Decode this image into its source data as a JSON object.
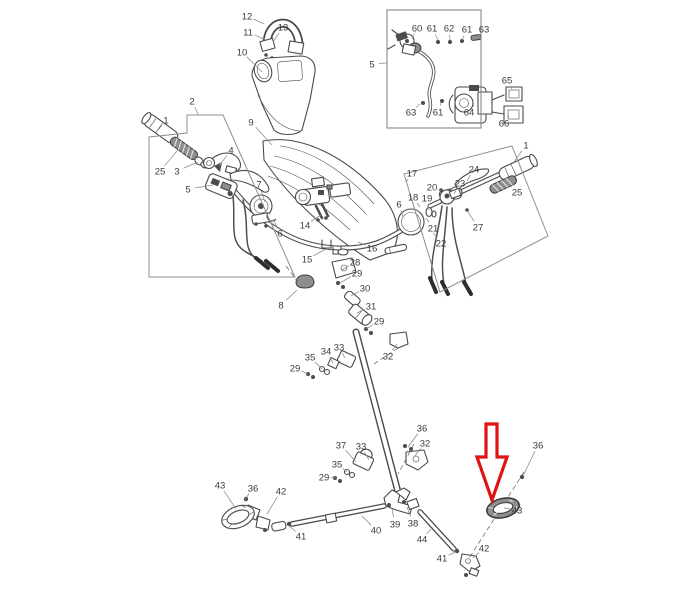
{
  "figure": {
    "kind": "exploded-parts-diagram",
    "subject": "handlebar and steering column assembly",
    "width": 691,
    "height": 600,
    "background": "#ffffff",
    "line_color": "#4a4a4a",
    "label_color": "#3b3b3b",
    "leader_color": "#8a8a8a",
    "label_font_px": 9.5
  },
  "highlight_arrow": {
    "color": "#e11212",
    "fill": "#ffffff",
    "points_to_part": "43",
    "polygon": [
      [
        486,
        424
      ],
      [
        497,
        424
      ],
      [
        497,
        457
      ],
      [
        507,
        457
      ],
      [
        492,
        500
      ],
      [
        477,
        457
      ],
      [
        486,
        457
      ]
    ]
  },
  "callout_regions": [
    {
      "name": "left-controls-region",
      "label": "2",
      "color": "#8f8f8f",
      "points": [
        [
          187,
          115
        ],
        [
          223,
          115
        ],
        [
          295,
          277
        ],
        [
          149,
          277
        ],
        [
          149,
          137
        ],
        [
          187,
          133
        ]
      ],
      "closed": true
    },
    {
      "name": "right-controls-region",
      "label": "17",
      "color": "#8f8f8f",
      "points": [
        [
          404,
          174
        ],
        [
          512,
          146
        ],
        [
          548,
          236
        ],
        [
          440,
          292
        ]
      ],
      "closed": true
    },
    {
      "name": "inset-detail-box",
      "label": "5",
      "color": "#7d7d7d",
      "points": [
        [
          387,
          10
        ],
        [
          481,
          10
        ],
        [
          481,
          128
        ],
        [
          387,
          128
        ]
      ],
      "closed": true
    }
  ],
  "part_labels": [
    {
      "n": "12",
      "x": 247,
      "y": 16,
      "lx": 264,
      "ly": 24
    },
    {
      "n": "11",
      "x": 248,
      "y": 32,
      "lx": 266,
      "ly": 40
    },
    {
      "n": "13",
      "x": 283,
      "y": 27,
      "lx": 273,
      "ly": 42
    },
    {
      "n": "10",
      "x": 242,
      "y": 52,
      "lx": 262,
      "ly": 72
    },
    {
      "n": "2",
      "x": 192,
      "y": 101,
      "lx": 198,
      "ly": 114
    },
    {
      "n": "9",
      "x": 251,
      "y": 122,
      "lx": 272,
      "ly": 145
    },
    {
      "n": "1",
      "x": 166,
      "y": 120,
      "lx": 158,
      "ly": 130
    },
    {
      "n": "25",
      "x": 160,
      "y": 171,
      "lx": 178,
      "ly": 150
    },
    {
      "n": "3",
      "x": 177,
      "y": 171,
      "lx": 198,
      "ly": 162
    },
    {
      "n": "4",
      "x": 231,
      "y": 150,
      "lx": 219,
      "ly": 166
    },
    {
      "n": "5",
      "x": 188,
      "y": 189,
      "lx": 213,
      "ly": 185
    },
    {
      "n": "7",
      "x": 259,
      "y": 184,
      "lx": 265,
      "ly": 202
    },
    {
      "n": "6",
      "x": 280,
      "y": 233,
      "lx": 273,
      "ly": 219
    },
    {
      "n": "14",
      "x": 305,
      "y": 225,
      "lx": 321,
      "ly": 215
    },
    {
      "n": "15",
      "x": 307,
      "y": 259,
      "lx": 328,
      "ly": 248
    },
    {
      "n": "16",
      "x": 372,
      "y": 248,
      "lx": 358,
      "ly": 242
    },
    {
      "n": "8",
      "x": 281,
      "y": 305,
      "lx": 297,
      "ly": 290
    },
    {
      "n": "28",
      "x": 355,
      "y": 262,
      "lx": 342,
      "ly": 270
    },
    {
      "n": "29",
      "x": 357,
      "y": 273,
      "lx": 340,
      "ly": 283
    },
    {
      "n": "30",
      "x": 365,
      "y": 288,
      "lx": 351,
      "ly": 296
    },
    {
      "n": "31",
      "x": 371,
      "y": 306,
      "lx": 357,
      "ly": 313
    },
    {
      "n": "29",
      "x": 379,
      "y": 321,
      "lx": 366,
      "ly": 329
    },
    {
      "n": "33",
      "x": 339,
      "y": 347,
      "lx": 345,
      "ly": 358
    },
    {
      "n": "34",
      "x": 326,
      "y": 351,
      "lx": 333,
      "ly": 363
    },
    {
      "n": "35",
      "x": 310,
      "y": 357,
      "lx": 322,
      "ly": 369
    },
    {
      "n": "29",
      "x": 295,
      "y": 368,
      "lx": 308,
      "ly": 374
    },
    {
      "n": "32",
      "x": 388,
      "y": 356,
      "lx": 397,
      "ly": 344
    },
    {
      "n": "36",
      "x": 422,
      "y": 428,
      "lx": 408,
      "ly": 447
    },
    {
      "n": "32",
      "x": 425,
      "y": 443,
      "lx": 414,
      "ly": 457
    },
    {
      "n": "37",
      "x": 341,
      "y": 445,
      "lx": 356,
      "ly": 462
    },
    {
      "n": "33",
      "x": 361,
      "y": 446,
      "lx": 369,
      "ly": 460
    },
    {
      "n": "35",
      "x": 337,
      "y": 464,
      "lx": 347,
      "ly": 472
    },
    {
      "n": "29",
      "x": 324,
      "y": 477,
      "lx": 336,
      "ly": 478
    },
    {
      "n": "43",
      "x": 220,
      "y": 485,
      "lx": 236,
      "ly": 509
    },
    {
      "n": "36",
      "x": 253,
      "y": 488,
      "lx": 244,
      "ly": 501
    },
    {
      "n": "42",
      "x": 281,
      "y": 491,
      "lx": 267,
      "ly": 514
    },
    {
      "n": "41",
      "x": 301,
      "y": 536,
      "lx": 288,
      "ly": 525
    },
    {
      "n": "40",
      "x": 376,
      "y": 530,
      "lx": 362,
      "ly": 516
    },
    {
      "n": "39",
      "x": 395,
      "y": 524,
      "lx": 392,
      "ly": 509
    },
    {
      "n": "38",
      "x": 413,
      "y": 523,
      "lx": 407,
      "ly": 507
    },
    {
      "n": "44",
      "x": 422,
      "y": 539,
      "lx": 431,
      "ly": 529
    },
    {
      "n": "41",
      "x": 442,
      "y": 558,
      "lx": 456,
      "ly": 552
    },
    {
      "n": "42",
      "x": 484,
      "y": 548,
      "lx": 473,
      "ly": 558
    },
    {
      "n": "43",
      "x": 517,
      "y": 510,
      "lx": 504,
      "ly": 508
    },
    {
      "n": "36",
      "x": 538,
      "y": 445,
      "lx": 523,
      "ly": 476
    },
    {
      "n": "17",
      "x": 412,
      "y": 173,
      "lx": 406,
      "ly": 182
    },
    {
      "n": "24",
      "x": 474,
      "y": 169,
      "lx": 467,
      "ly": 181
    },
    {
      "n": "23",
      "x": 460,
      "y": 183,
      "lx": 454,
      "ly": 194
    },
    {
      "n": "20",
      "x": 432,
      "y": 187,
      "lx": 441,
      "ly": 191
    },
    {
      "n": "18",
      "x": 413,
      "y": 197,
      "lx": 420,
      "ly": 207
    },
    {
      "n": "19",
      "x": 427,
      "y": 198,
      "lx": 429,
      "ly": 210
    },
    {
      "n": "6",
      "x": 399,
      "y": 204,
      "lx": 403,
      "ly": 217
    },
    {
      "n": "1",
      "x": 526,
      "y": 145,
      "lx": 514,
      "ly": 162
    },
    {
      "n": "25",
      "x": 517,
      "y": 192,
      "lx": 506,
      "ly": 182
    },
    {
      "n": "21",
      "x": 433,
      "y": 228,
      "lx": 426,
      "ly": 218
    },
    {
      "n": "27",
      "x": 478,
      "y": 227,
      "lx": 468,
      "ly": 212
    },
    {
      "n": "22",
      "x": 441,
      "y": 243,
      "lx": 433,
      "ly": 233
    },
    {
      "n": "5",
      "x": 372,
      "y": 64,
      "lx": 387,
      "ly": 63
    },
    {
      "n": "60",
      "x": 417,
      "y": 28,
      "lx": 412,
      "ly": 39
    },
    {
      "n": "61",
      "x": 432,
      "y": 28,
      "lx": 438,
      "ly": 40
    },
    {
      "n": "62",
      "x": 449,
      "y": 28,
      "lx": 450,
      "ly": 40
    },
    {
      "n": "61",
      "x": 467,
      "y": 29,
      "lx": 462,
      "ly": 40
    },
    {
      "n": "63",
      "x": 484,
      "y": 29,
      "lx": 477,
      "ly": 38
    },
    {
      "n": "63",
      "x": 411,
      "y": 112,
      "lx": 420,
      "ly": 104
    },
    {
      "n": "61",
      "x": 438,
      "y": 112,
      "lx": 441,
      "ly": 103
    },
    {
      "n": "64",
      "x": 469,
      "y": 112,
      "lx": 474,
      "ly": 105
    },
    {
      "n": "65",
      "x": 507,
      "y": 80,
      "lx": 512,
      "ly": 89
    },
    {
      "n": "66",
      "x": 504,
      "y": 123,
      "lx": 509,
      "ly": 116
    }
  ]
}
